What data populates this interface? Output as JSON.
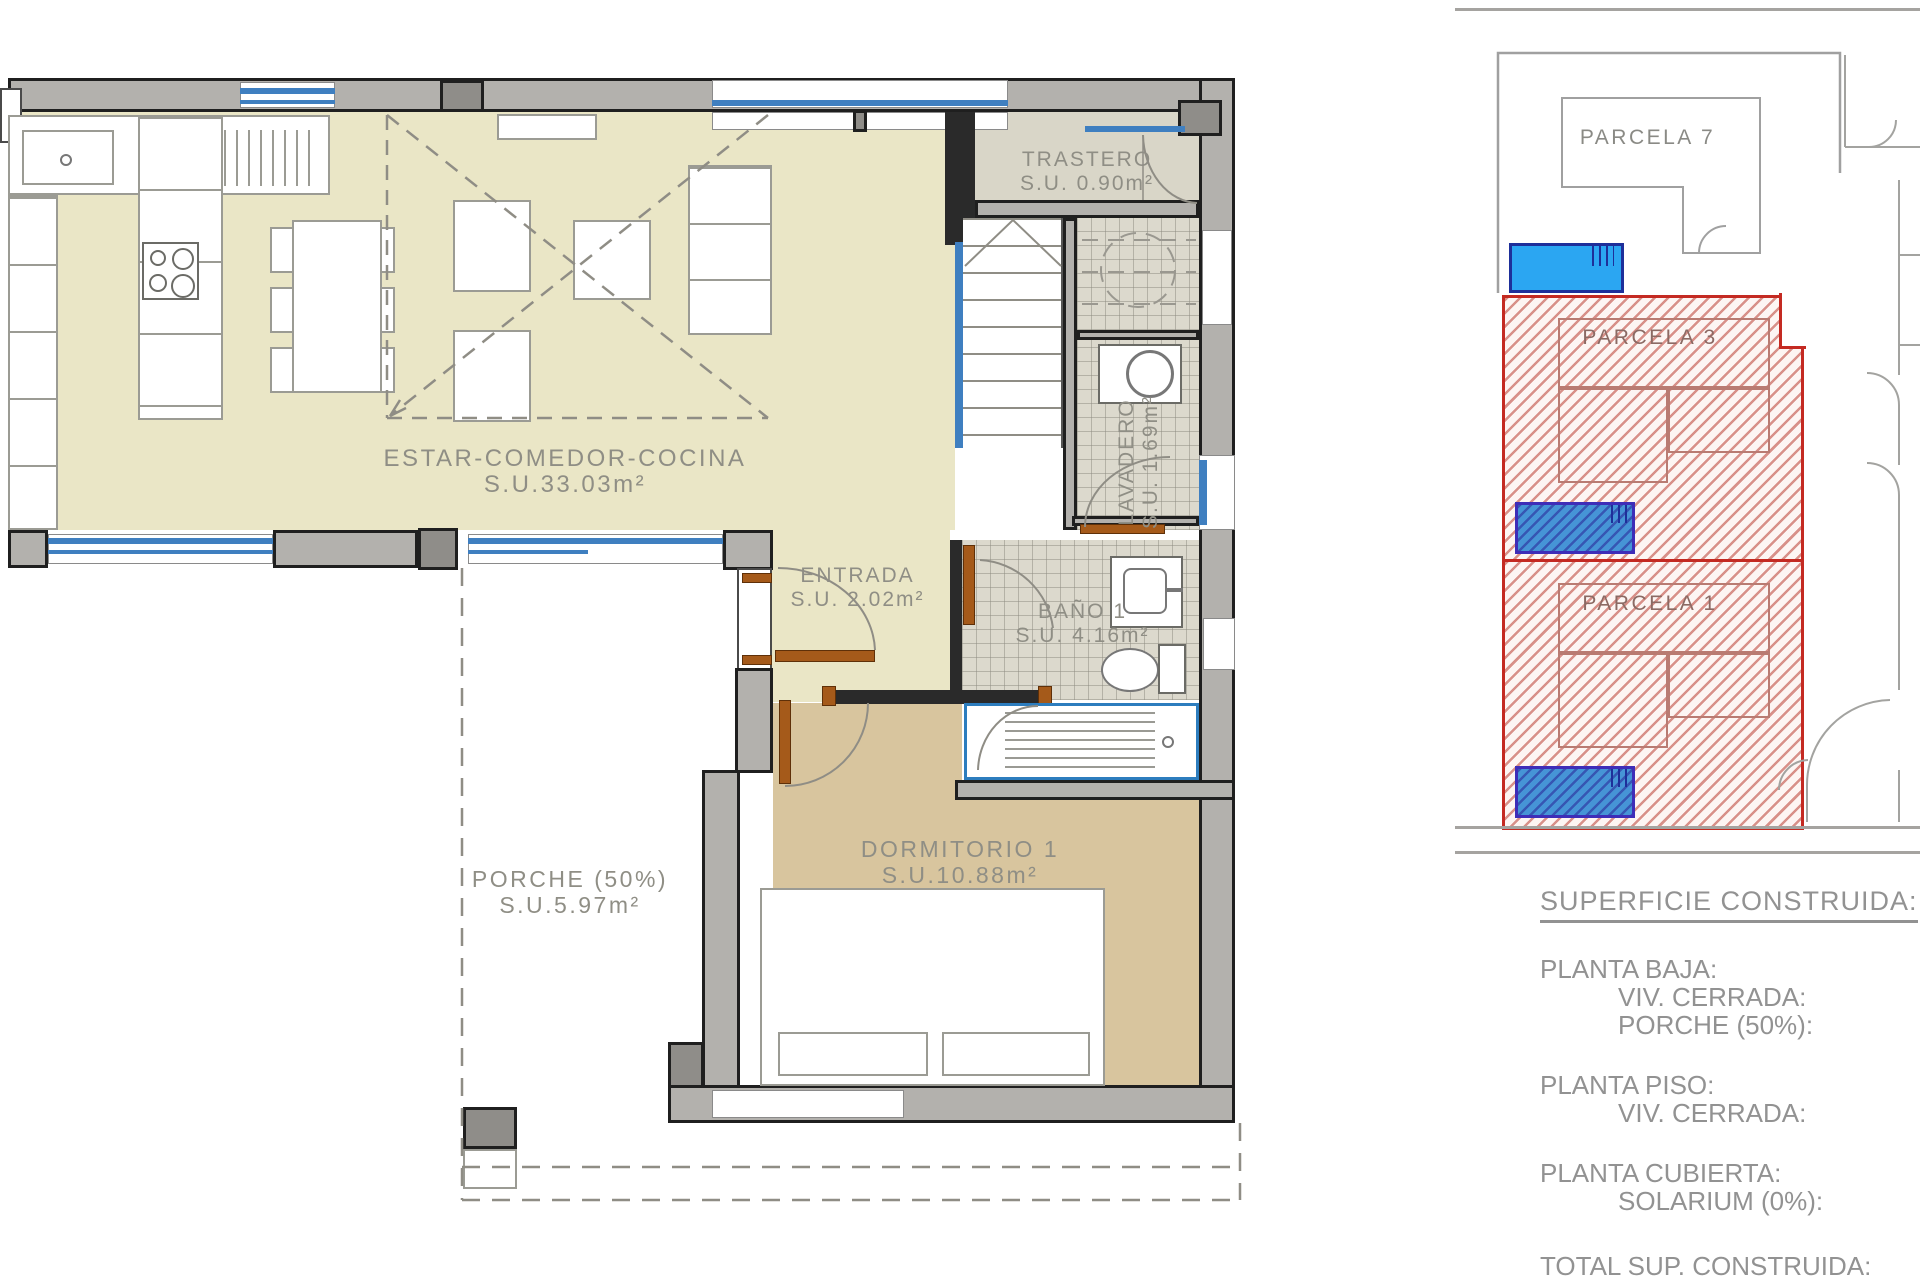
{
  "floor_plan": {
    "rooms": {
      "estar": {
        "label": "ESTAR-COMEDOR-COCINA",
        "area": "S.U.33.03m²"
      },
      "trastero": {
        "label": "TRASTERO",
        "area": "S.U. 0.90m²"
      },
      "lavadero": {
        "label": "LAVADERO",
        "area": "S.U. 1.69m²"
      },
      "entrada": {
        "label": "ENTRADA",
        "area": "S.U. 2.02m²"
      },
      "bano": {
        "label": "BAÑO 1",
        "area": "S.U. 4.16m²"
      },
      "dormitorio": {
        "label": "DORMITORIO 1",
        "area": "S.U.10.88m²"
      },
      "porche": {
        "label": "PORCHE (50%)",
        "area": "S.U.5.97m²"
      }
    }
  },
  "site_plan": {
    "parcels": {
      "p7": {
        "label": "PARCELA 7"
      },
      "p3": {
        "label": "PARCELA 3"
      },
      "p1": {
        "label": "PARCELA 1"
      }
    }
  },
  "summary": {
    "title": "SUPERFICIE CONSTRUIDA:",
    "planta_baja": {
      "heading": "PLANTA BAJA:",
      "item1": "VIV. CERRADA:",
      "item2": "PORCHE (50%):"
    },
    "planta_piso": {
      "heading": "PLANTA PISO:",
      "item1": "VIV. CERRADA:"
    },
    "planta_cubierta": {
      "heading": "PLANTA CUBIERTA:",
      "item1": "SOLARIUM (0%):"
    },
    "total": "TOTAL SUP. CONSTRUIDA:"
  },
  "colors": {
    "room_beige": "#eae6c6",
    "bedroom_tan": "#d8c59e",
    "window_blue": "#3f7fc0",
    "door_brown": "#a55a1a",
    "parcel_red": "#c42a22",
    "pool_blue": "#2ba6f2",
    "pool_border": "#1e2f9a"
  }
}
